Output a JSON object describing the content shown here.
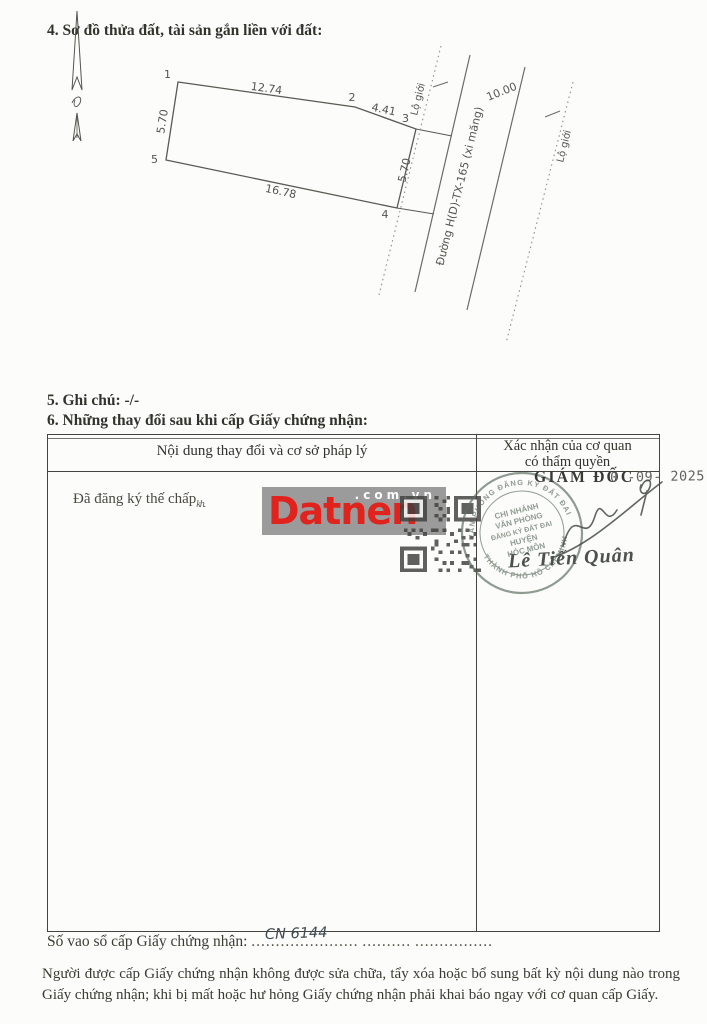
{
  "page": {
    "section4_title": "4. Sơ đồ thửa đất, tài sản gắn liền với đất:",
    "section5": "5. Ghi chú: -/-",
    "section6": "6. Những thay đổi sau khi cấp Giấy chứng nhận:",
    "footer_line1": "Người được cấp Giấy chứng nhận không được sửa chữa, tẩy xóa hoặc bổ sung bất kỳ nội dung nào trong",
    "footer_line2": "Giấy chứng nhận; khi bị mất hoặc hư hỏng Giấy chứng nhận phải khai báo ngay với cơ quan cấp Giấy."
  },
  "diagram": {
    "v1": "1",
    "v2": "2",
    "v3": "3",
    "v4": "4",
    "v5": "5",
    "d12": "12.74",
    "d23": "4.41",
    "d34": "5.70",
    "d54": "16.78",
    "d15": "5.70",
    "road_width": "10.00",
    "road_name": "Đường H(D)-TX-165 (xi măng)",
    "lo_gioi_1": "Lộ giới",
    "lo_gioi_2": "Lộ giới"
  },
  "table": {
    "header_left": "Nội dung thay đổi và cơ sở pháp lý",
    "header_right_1": "Xác nhận của cơ quan",
    "header_right_2": "có thẩm quyền",
    "entry": "Đã đăng ký thế chấp",
    "entry_note": "kh.",
    "director_title": "GIÁM ĐỐC",
    "date_stamp": "0 -09- 2025",
    "signer_name": "Lê Tiến Quân",
    "stamp": {
      "line1": "CHI NHÁNH",
      "line2": "VĂN PHÒNG",
      "line3": "ĐĂNG KÝ ĐẤT ĐAI",
      "line4": "HUYỆN",
      "line5": "HÓC MÔN",
      "rim_top": "VĂN PHÒNG ĐĂNG KÝ ĐẤT ĐAI",
      "rim_bottom": "THÀNH PHỐ HỒ CHÍ MINH"
    }
  },
  "register": {
    "label": "Số vao sổ cấp Giấy chứng nhận:",
    "dots_a": "......................",
    "value": "CN 6144",
    "dots_b": "..........",
    "dots_c": "................"
  },
  "watermark": {
    "brand": "Datnen",
    "domain": ".com.vn"
  },
  "colors": {
    "brand_red": "#e0231c",
    "watermark_gray": "#9b9b9b",
    "stamp_green": "#5d6e60",
    "ink": "#2e2e2a",
    "paper": "#fcfcfa"
  }
}
